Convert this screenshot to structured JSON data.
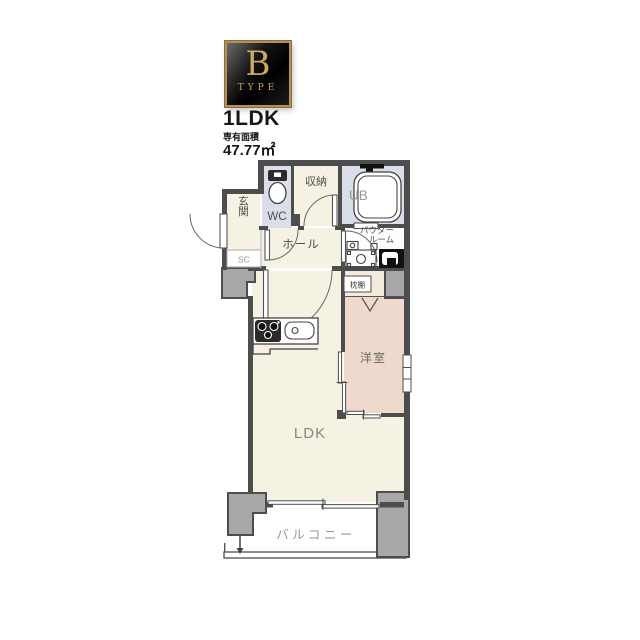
{
  "badge": {
    "letter": "B",
    "type_label": "TYPE"
  },
  "unit": {
    "layout_name": "1LDK",
    "area_caption": "専有面積",
    "area_value": "47.77㎡"
  },
  "rooms": {
    "wc": "WC",
    "storage": "収納",
    "unit_bath": "UB",
    "entrance": "玄関",
    "shoe_closet": "SC",
    "hall": "ホール",
    "powder_room_line1": "パウダー",
    "powder_room_line2": "ルーム",
    "pillow_shelf": "枕棚",
    "western_room": "洋室",
    "ldk": "LDK",
    "balcony": "バルコニー"
  },
  "colors": {
    "wall": "#4d4d4d",
    "floor_cream": "#f5f1e3",
    "floor_pink": "#eed9cc",
    "floor_blue": "#d9dee9",
    "closet_cream": "#f3ecdc",
    "powder_floor": "#fdfdfd",
    "pillar_gray": "#a8a8a8",
    "badge_gold": "#c9a45c"
  }
}
